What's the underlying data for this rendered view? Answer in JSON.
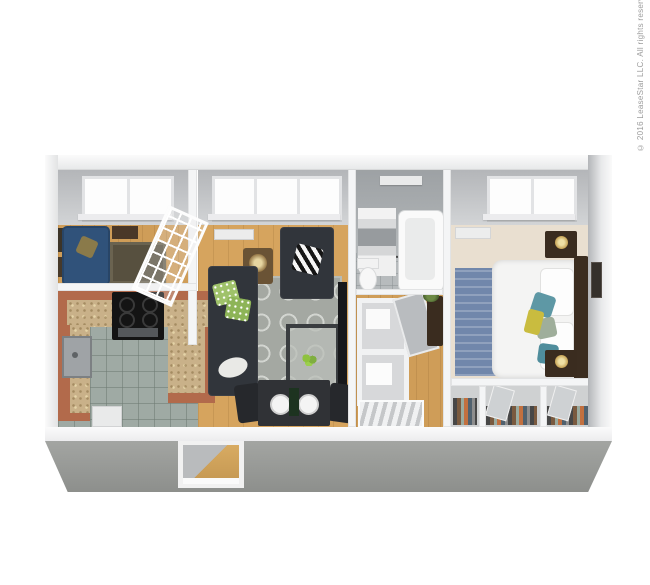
{
  "image": {
    "kind": "3d-apartment-floor-plan-render",
    "background": "#ffffff",
    "rooms": [
      "den",
      "kitchen",
      "living-room",
      "dining-area",
      "bathroom",
      "hallway-closets",
      "bedroom",
      "wardrobe-closets"
    ]
  },
  "watermark": {
    "text": "© 2016 LeaseStar LLC. All rights reserved."
  },
  "palette": {
    "exterior_wall": "#f7f8f8",
    "interior_wall_face": "#c3c5c8",
    "front_wall": "#9a9c99",
    "wood_floor": "#d6a45e",
    "kitchen_tile": "#9faaa4",
    "bath_tile": "#b7bbbd",
    "carpet": "#e9dfd0",
    "cabinet_terracotta": "#b26a4b",
    "countertop_granite": "#c9b189",
    "sofa_dark": "#31353b",
    "sofa_blue": "#30527a",
    "living_rug": "#a4a8a2",
    "bedroom_rug": "#7187ab",
    "bed_linen": "#f4f4f3",
    "dark_wood": "#3a2c1f",
    "accent_green": "#9fc26a",
    "accent_teal": "#5e98a5",
    "accent_yellow": "#c9bc3f"
  }
}
